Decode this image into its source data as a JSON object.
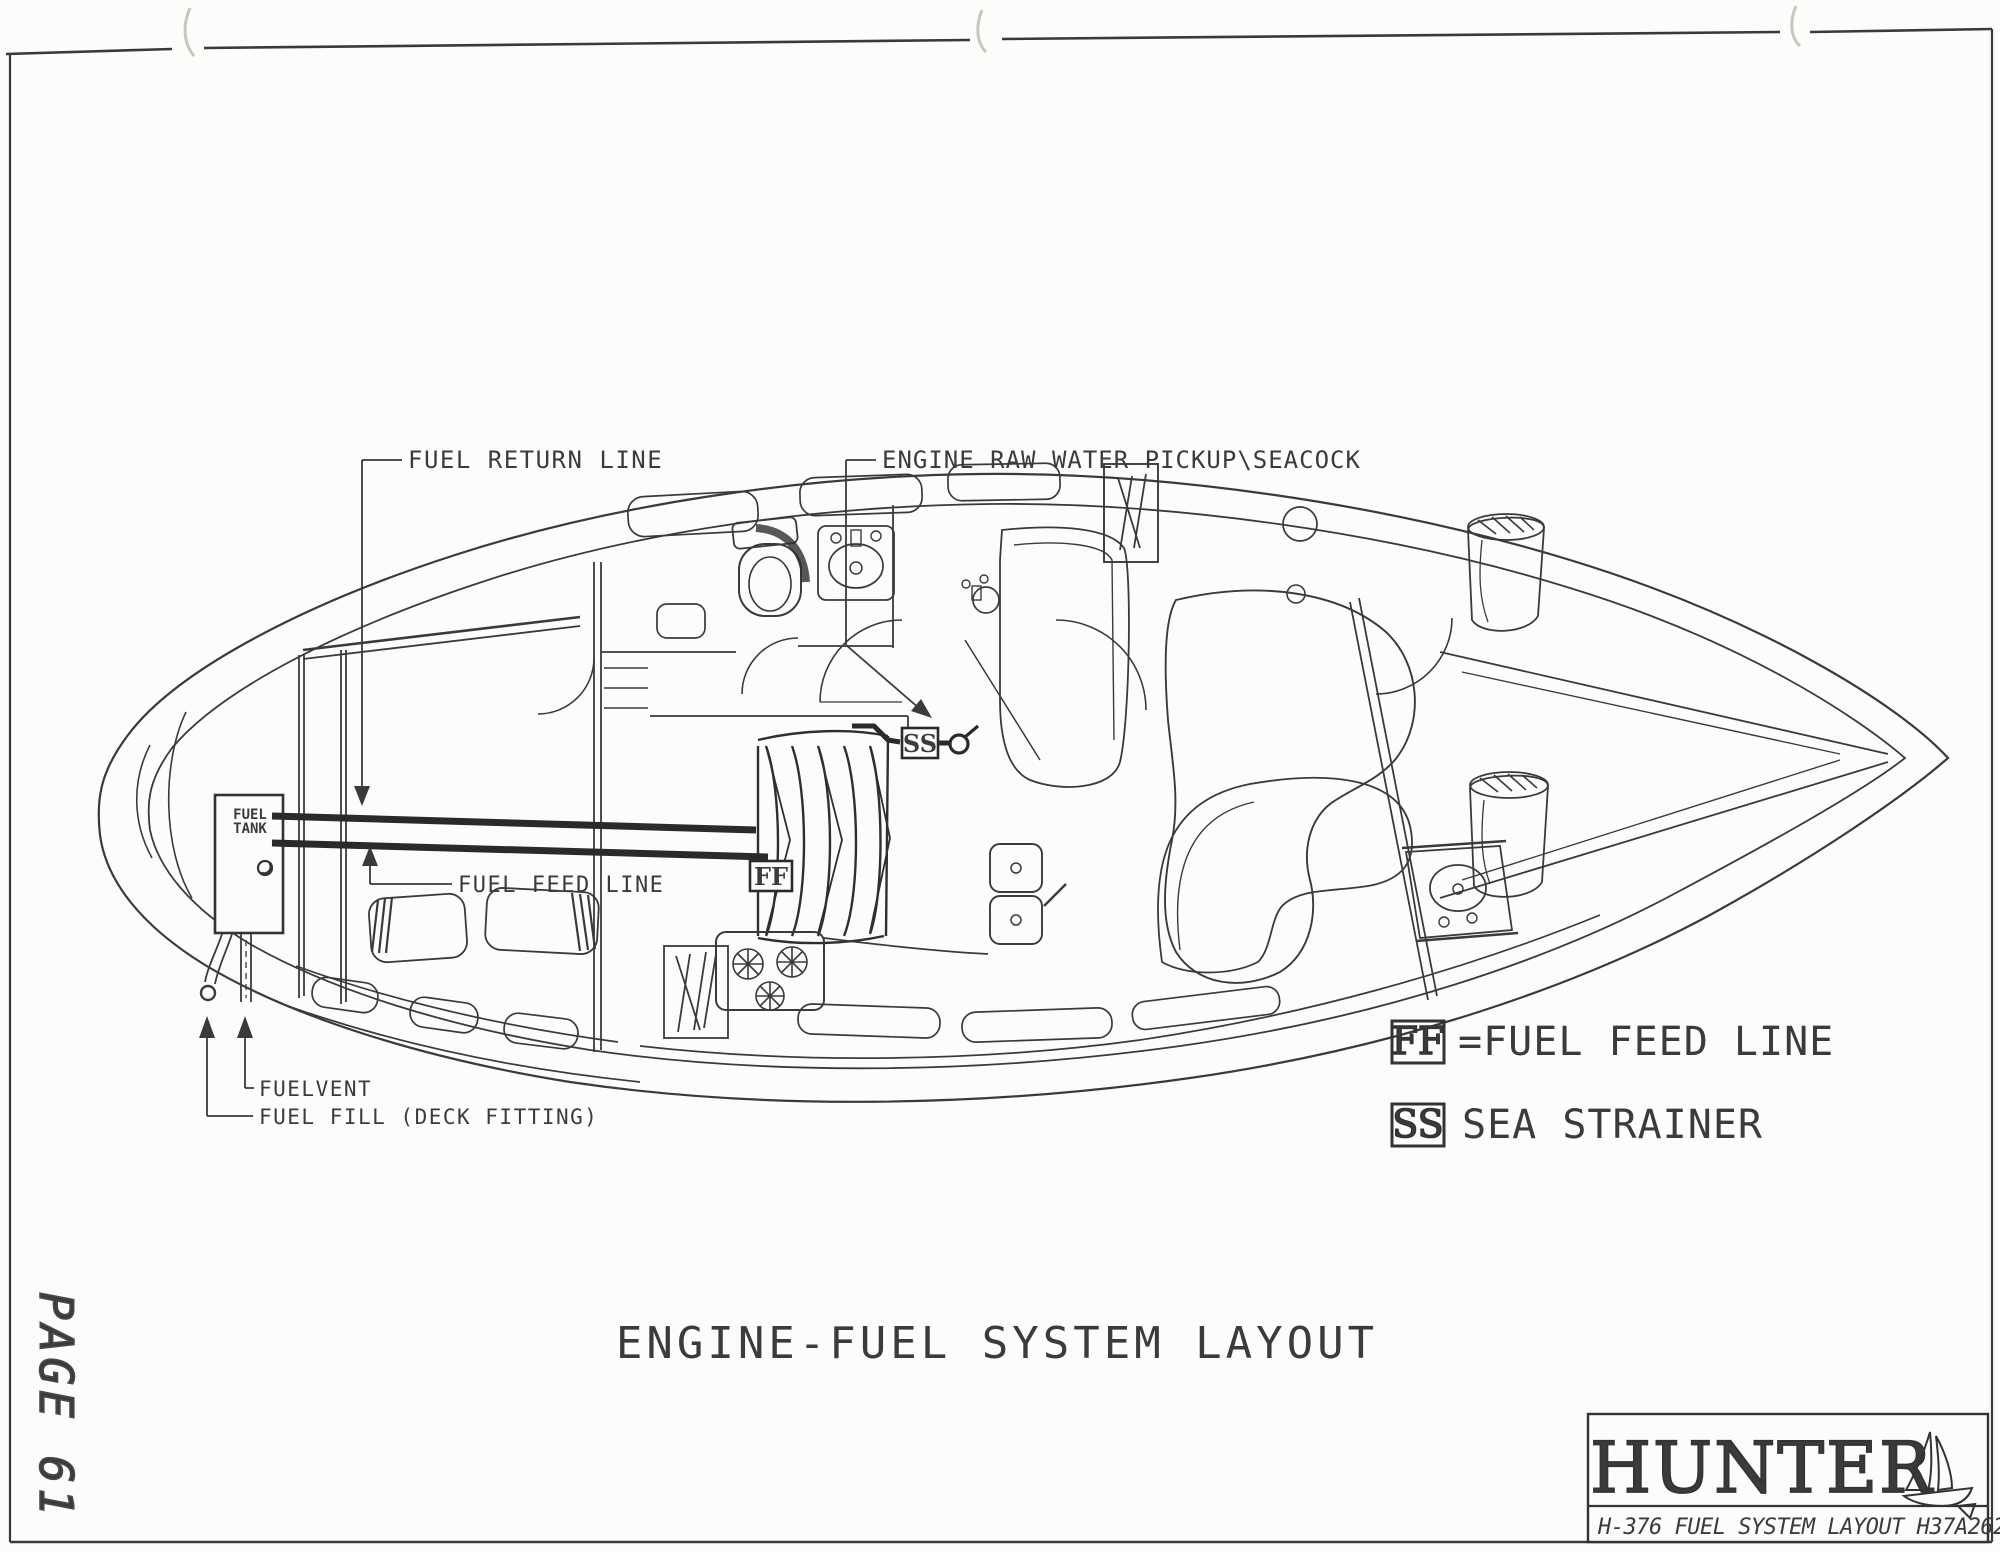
{
  "page": {
    "number": "PAGE 61"
  },
  "drawing": {
    "title": "ENGINE-FUEL SYSTEM LAYOUT",
    "labels": {
      "fuel_return": "FUEL RETURN LINE",
      "raw_water": "ENGINE RAW WATER PICKUP\\SEACOCK",
      "fuel_feed": "FUEL FEED LINE",
      "fuel_vent": "FUELVENT",
      "fuel_fill": "FUEL FILL (DECK FITTING)"
    },
    "tank": {
      "line1": "FUEL",
      "line2": "TANK"
    },
    "markers": {
      "ff": "FF",
      "ss": "SS"
    }
  },
  "legend": {
    "items": [
      {
        "symbol": "FF",
        "label": "=FUEL FEED LINE"
      },
      {
        "symbol": "SS",
        "label": "SEA STRAINER"
      }
    ]
  },
  "title_block": {
    "brand": "HUNTER",
    "subtitle": "H-376 FUEL SYSTEM LAYOUT H37A2628"
  },
  "colors": {
    "ink": "#3a3a3a",
    "heavy_line": "#2a2a2a",
    "paper": "#fcfcfa"
  }
}
